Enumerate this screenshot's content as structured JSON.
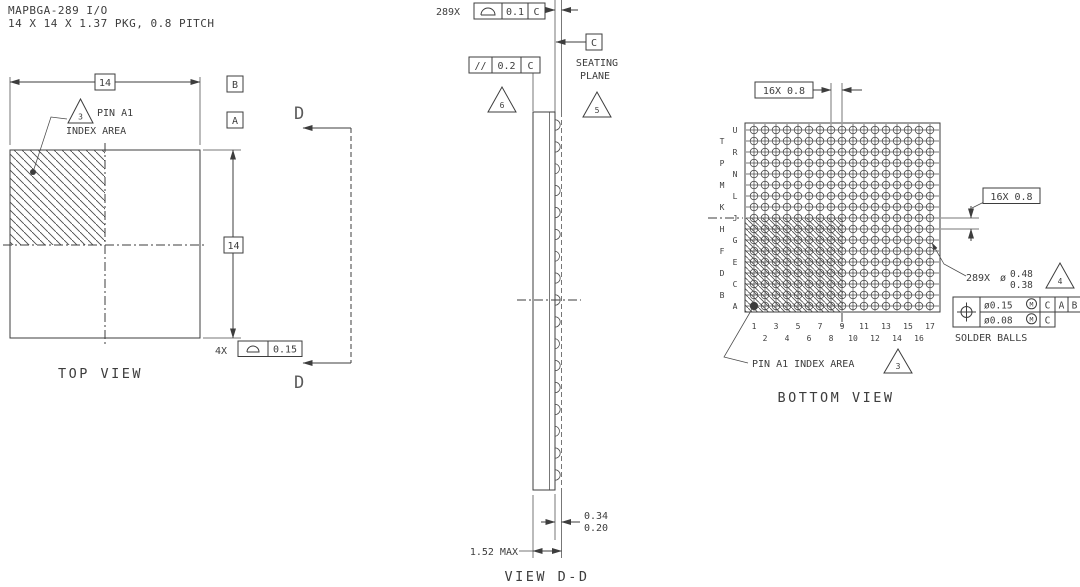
{
  "header": {
    "line1": "MAPBGA-289 I/O",
    "line2": "14 X 14 X 1.37 PKG, 0.8 PITCH"
  },
  "top_view": {
    "title": "TOP VIEW",
    "dim_width": "14",
    "dim_height": "14",
    "datum_a": "A",
    "datum_b": "B",
    "pin_flag": "3",
    "pin_line1": "PIN A1",
    "pin_line2": "INDEX AREA",
    "corner_count": "4X",
    "corner_tol": "0.15"
  },
  "section": {
    "top": "D",
    "bottom": "D"
  },
  "side_view": {
    "title": "VIEW D-D",
    "ball_fcf": {
      "count": "289X",
      "tol": "0.1",
      "datum": "C"
    },
    "par_fcf": {
      "sym": "//",
      "tol": "0.2",
      "datum": "C"
    },
    "flag_parallel": "6",
    "flag_seating": "5",
    "datum_c": "C",
    "seating1": "SEATING",
    "seating2": "PLANE",
    "standoff_max": "0.34",
    "standoff_min": "0.20",
    "overall": "1.52 MAX",
    "balls": {
      "n": 17,
      "x": 555,
      "y0": 125,
      "y1": 475,
      "r": 5.2
    }
  },
  "bottom_view": {
    "title": "BOTTOM VIEW",
    "pitch_top": "16X 0.8",
    "pitch_right": "16X 0.8",
    "rows": [
      "U",
      "T",
      "R",
      "P",
      "N",
      "M",
      "L",
      "K",
      "J",
      "H",
      "G",
      "F",
      "E",
      "D",
      "C",
      "B",
      "A"
    ],
    "cols": [
      "1",
      "2",
      "3",
      "4",
      "5",
      "6",
      "7",
      "8",
      "9",
      "10",
      "11",
      "12",
      "13",
      "14",
      "15",
      "16",
      "17"
    ],
    "ball_spec": {
      "count": "289X",
      "dia": "ø",
      "max": "0.48",
      "min": "0.38",
      "flag": "4"
    },
    "fcf": {
      "tol1": "ø0.15",
      "mod1": "M",
      "dat1": [
        "C",
        "A",
        "B"
      ],
      "tol2": "ø0.08",
      "mod2": "M",
      "dat2": [
        "C"
      ]
    },
    "solder_label": "SOLDER BALLS",
    "pin_label": "PIN A1 INDEX AREA",
    "pin_flag": "3",
    "grid": {
      "n": 17,
      "x0": 754,
      "y0": 130,
      "pitch": 11,
      "r": 3.8,
      "border": {
        "x": 745,
        "y": 123,
        "w": 195,
        "h": 189
      },
      "label_inner_x": 735,
      "label_outer_x": 722,
      "num_y1": 329,
      "num_y2": 341
    }
  }
}
